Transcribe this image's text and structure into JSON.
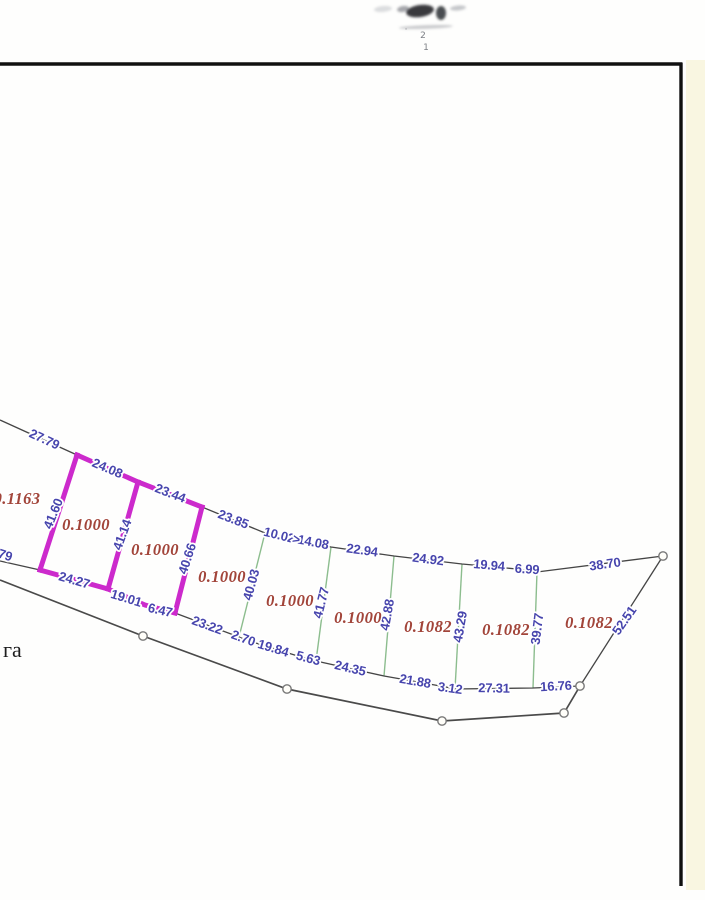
{
  "page": {
    "width": 705,
    "height": 900,
    "background": "#fefefd",
    "frame_color": "#101010",
    "edge_tint": "#f4eecb"
  },
  "map": {
    "colors": {
      "boundary": "#454545",
      "road": "#4a4a4a",
      "divider_green": "#8cbd8e",
      "highlight_magenta": "#cc2acc",
      "dimension_text": "#4745ad",
      "area_text": "#a2453a",
      "note_text": "#1e1e1e",
      "point_fill": "#fffef9",
      "point_stroke": "#787878"
    },
    "polylines": {
      "north_boundary": [
        [
          0,
          420
        ],
        [
          77,
          455
        ],
        [
          138,
          482
        ],
        [
          202,
          507
        ],
        [
          265,
          533
        ],
        [
          293,
          540
        ],
        [
          331,
          547
        ],
        [
          394,
          556
        ],
        [
          462,
          564
        ],
        [
          517,
          569
        ],
        [
          537,
          572
        ],
        [
          663,
          556
        ]
      ],
      "south_boundary": [
        [
          0,
          561
        ],
        [
          40,
          570
        ],
        [
          108,
          589
        ],
        [
          145,
          605
        ],
        [
          175,
          613
        ],
        [
          239,
          637
        ],
        [
          246,
          640
        ],
        [
          301,
          657
        ],
        [
          316,
          661
        ],
        [
          384,
          676
        ],
        [
          446,
          687
        ],
        [
          455,
          689
        ],
        [
          533,
          688
        ],
        [
          580,
          686
        ]
      ],
      "east_boundary": [
        [
          580,
          686
        ],
        [
          663,
          556
        ]
      ],
      "road": [
        [
          0,
          580
        ],
        [
          143,
          636
        ],
        [
          287,
          689
        ],
        [
          442,
          721
        ],
        [
          564,
          713
        ],
        [
          580,
          686
        ]
      ]
    },
    "magenta_highlight": {
      "top": [
        [
          77,
          455
        ],
        [
          138,
          482
        ],
        [
          202,
          507
        ]
      ],
      "bottom": [
        [
          40,
          570
        ],
        [
          108,
          589
        ],
        [
          145,
          605
        ],
        [
          175,
          613
        ]
      ],
      "verticals": [
        [
          [
            77,
            455
          ],
          [
            40,
            570
          ]
        ],
        [
          [
            138,
            482
          ],
          [
            108,
            589
          ]
        ],
        [
          [
            202,
            507
          ],
          [
            175,
            613
          ]
        ]
      ]
    },
    "green_dividers": [
      [
        [
          265,
          533
        ],
        [
          239,
          637
        ]
      ],
      [
        [
          331,
          547
        ],
        [
          316,
          661
        ]
      ],
      [
        [
          394,
          556
        ],
        [
          384,
          676
        ]
      ],
      [
        [
          462,
          564
        ],
        [
          455,
          689
        ]
      ],
      [
        [
          537,
          572
        ],
        [
          533,
          688
        ]
      ]
    ],
    "survey_points": [
      [
        143,
        636
      ],
      [
        287,
        689
      ],
      [
        442,
        721
      ],
      [
        564,
        713
      ],
      [
        580,
        686
      ],
      [
        663,
        556
      ]
    ],
    "dimension_labels": [
      {
        "text": "27.79",
        "x": 44,
        "y": 440,
        "rot": 25
      },
      {
        "text": "24.08",
        "x": 107,
        "y": 469,
        "rot": 23
      },
      {
        "text": "23.44",
        "x": 170,
        "y": 494,
        "rot": 21
      },
      {
        "text": "23.85",
        "x": 233,
        "y": 520,
        "rot": 21
      },
      {
        "text": "10.02",
        "x": 279,
        "y": 536,
        "rot": 14
      },
      {
        "text": "14.08",
        "x": 313,
        "y": 543,
        "rot": 11
      },
      {
        "text": "22.94",
        "x": 362,
        "y": 551,
        "rot": 8
      },
      {
        "text": "24.92",
        "x": 428,
        "y": 560,
        "rot": 7
      },
      {
        "text": "19.94",
        "x": 489,
        "y": 566,
        "rot": 5
      },
      {
        "text": "6.99",
        "x": 527,
        "y": 570,
        "rot": 4
      },
      {
        "text": "38.70",
        "x": 605,
        "y": 565,
        "rot": -8
      },
      {
        "text": "52.51",
        "x": 625,
        "y": 621,
        "rot": -55
      },
      {
        "text": "41.60",
        "x": 54,
        "y": 514,
        "rot": -68
      },
      {
        "text": "41.14",
        "x": 123,
        "y": 535,
        "rot": -70
      },
      {
        "text": "40.66",
        "x": 188,
        "y": 559,
        "rot": -72
      },
      {
        "text": "40.03",
        "x": 252,
        "y": 585,
        "rot": -75
      },
      {
        "text": "41.77",
        "x": 322,
        "y": 603,
        "rot": -76
      },
      {
        "text": "42.88",
        "x": 388,
        "y": 615,
        "rot": -80
      },
      {
        "text": "43.29",
        "x": 461,
        "y": 627,
        "rot": -80
      },
      {
        "text": "39.77",
        "x": 538,
        "y": 629,
        "rot": -83
      },
      {
        "text": "24.27",
        "x": 74,
        "y": 581,
        "rot": 16
      },
      {
        "text": "19.01",
        "x": 126,
        "y": 599,
        "rot": 17
      },
      {
        "text": "6.47",
        "x": 160,
        "y": 611,
        "rot": 13
      },
      {
        "text": "23.22",
        "x": 207,
        "y": 626,
        "rot": 20
      },
      {
        "text": "2.70",
        "x": 243,
        "y": 639,
        "rot": 20
      },
      {
        "text": "19.84",
        "x": 273,
        "y": 649,
        "rot": 17
      },
      {
        "text": "5.63",
        "x": 308,
        "y": 659,
        "rot": 15
      },
      {
        "text": "24.35",
        "x": 350,
        "y": 669,
        "rot": 13
      },
      {
        "text": "21.88",
        "x": 415,
        "y": 682,
        "rot": 10
      },
      {
        "text": "3.12",
        "x": 450,
        "y": 689,
        "rot": 8
      },
      {
        "text": "27.31",
        "x": 494,
        "y": 689,
        "rot": 1
      },
      {
        "text": "16.76",
        "x": 556,
        "y": 687,
        "rot": -3
      },
      {
        "text": "79",
        "x": 5,
        "y": 556,
        "rot": 18
      }
    ],
    "tick_mark": {
      "text": ">",
      "x": 296,
      "y": 540,
      "rot": 14
    },
    "area_labels": [
      {
        "text": "0.1163",
        "x": 17,
        "y": 500
      },
      {
        "text": "0.1000",
        "x": 86,
        "y": 526
      },
      {
        "text": "0.1000",
        "x": 155,
        "y": 551
      },
      {
        "text": "0.1000",
        "x": 222,
        "y": 578
      },
      {
        "text": "0.1000",
        "x": 290,
        "y": 602
      },
      {
        "text": "0.1000",
        "x": 358,
        "y": 619
      },
      {
        "text": "0.1082",
        "x": 428,
        "y": 628
      },
      {
        "text": "0.1082",
        "x": 506,
        "y": 631
      },
      {
        "text": "0.1082",
        "x": 589,
        "y": 624
      }
    ],
    "note": {
      "text": "га",
      "x": 3,
      "y": 657
    }
  },
  "stamp": {
    "blobs": [
      {
        "x": 420,
        "y": 11,
        "rx": 14,
        "ry": 6,
        "rot": -8,
        "fill": "#23242a",
        "opacity": 0.9
      },
      {
        "x": 441,
        "y": 13,
        "rx": 5,
        "ry": 7,
        "rot": 0,
        "fill": "#2b2d33",
        "opacity": 0.85
      },
      {
        "x": 403,
        "y": 9,
        "rx": 6,
        "ry": 3,
        "rot": -10,
        "fill": "#6a6d74",
        "opacity": 0.6
      },
      {
        "x": 383,
        "y": 9,
        "rx": 9,
        "ry": 3,
        "rot": -5,
        "fill": "#b9bcc2",
        "opacity": 0.5
      },
      {
        "x": 458,
        "y": 8,
        "rx": 8,
        "ry": 2.5,
        "rot": -5,
        "fill": "#8e9197",
        "opacity": 0.5
      },
      {
        "x": 426,
        "y": 27,
        "rx": 27,
        "ry": 1.8,
        "rot": -2,
        "fill": "#9a9da3",
        "opacity": 0.55
      }
    ],
    "marks": [
      {
        "text": "2",
        "x": 423,
        "y": 38
      },
      {
        "text": "1",
        "x": 426,
        "y": 50
      },
      {
        "text": "·",
        "x": 406,
        "y": 32
      }
    ]
  }
}
